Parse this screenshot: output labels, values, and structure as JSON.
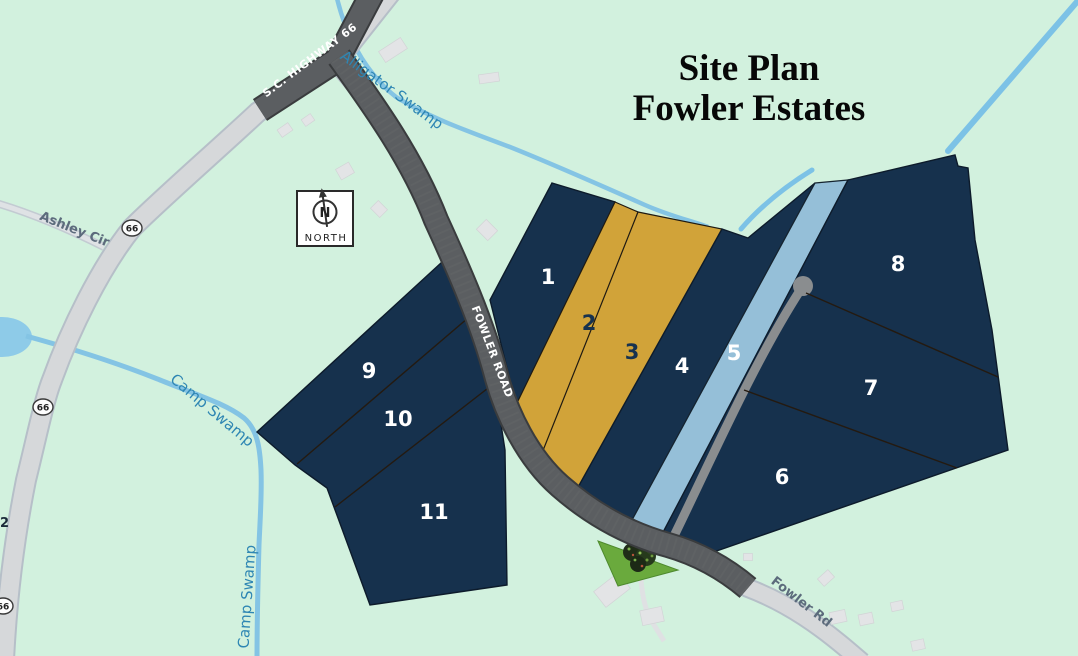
{
  "title": {
    "line1": "Site Plan",
    "line2": "Fowler Estates"
  },
  "compass": {
    "letter": "N",
    "label": "NORTH"
  },
  "road_labels": {
    "highway": "S.C. HIGHWAY 66",
    "fowler_road": "FOWLER ROAD",
    "fowler_rd": "Fowler Rd",
    "ashley_cir": "Ashley Cir",
    "route_badge": "66",
    "edge_fragment": "2"
  },
  "water_labels": {
    "alligator": "Alligator Swamp",
    "camp_upper": "Camp Swamp",
    "camp_lower": "Camp Swamp"
  },
  "lots": [
    {
      "number": "1"
    },
    {
      "number": "2"
    },
    {
      "number": "3"
    },
    {
      "number": "4"
    },
    {
      "number": "5"
    },
    {
      "number": "6"
    },
    {
      "number": "7"
    },
    {
      "number": "8"
    },
    {
      "number": "9"
    },
    {
      "number": "10"
    },
    {
      "number": "11"
    }
  ],
  "colors": {
    "background": "#d2f1de",
    "lot_navy": "#16314d",
    "lot_gold": "#d1a339",
    "lot_blue": "#95bfd8",
    "road_dark": "#5b5e61",
    "road_light": "#d6d8da",
    "stream": "#84c4e4",
    "grass_triangle": "#6aaa3d",
    "water_label": "#2e86b3",
    "road_label_gray": "#5c6b7c"
  }
}
